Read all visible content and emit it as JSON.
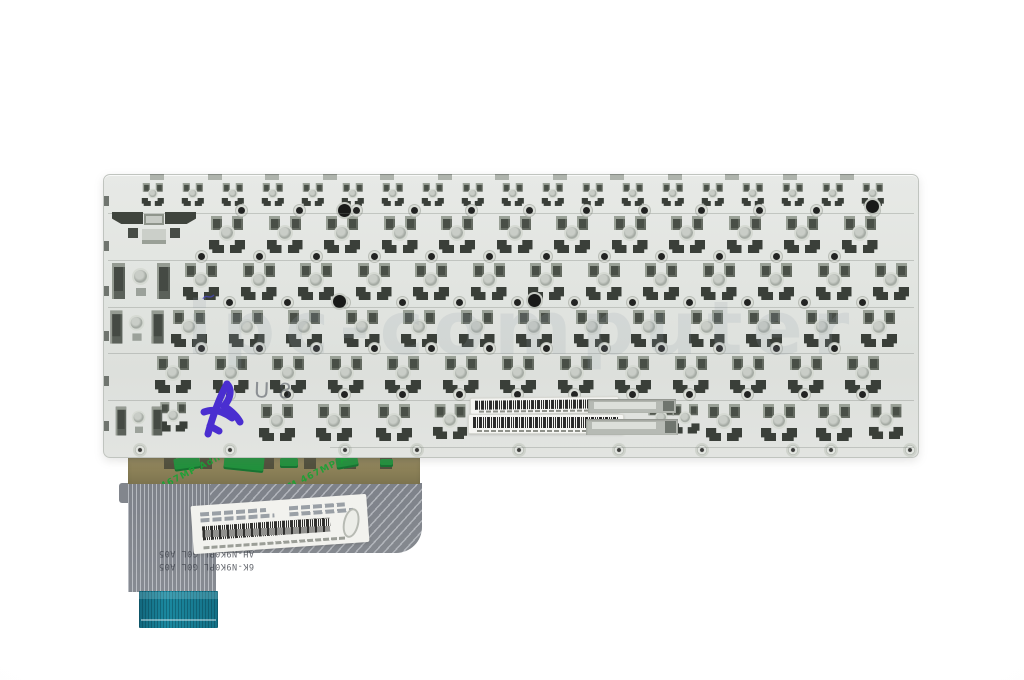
{
  "photo": {
    "subject": "laptop keyboard rear metal backplate with flex ribbon cable",
    "background_color": "#fcfcfc"
  },
  "watermark": {
    "text": "ipc-computer",
    "color": "#93a0ae"
  },
  "plate": {
    "base_color": "#e2e5e1",
    "mount_color": "#3f443e",
    "barcode_label_count": 2
  },
  "handwriting": {
    "pencil_text": "U8",
    "ink_mark_color": "#4a2ed0"
  },
  "adhesive_tape": {
    "brand_text": "3M 467MP Adhesive",
    "text_color": "#18a335",
    "tape_color": "#8b8057"
  },
  "flex_cable": {
    "sheet_color": "#82868d",
    "connector_color": "#15798f",
    "print_lines": [
      "U20H 10",
      "UP0BU UK 32",
      "AH-N9K0PL G0L A05",
      "6K-N9K0PL G0L A05"
    ]
  }
}
